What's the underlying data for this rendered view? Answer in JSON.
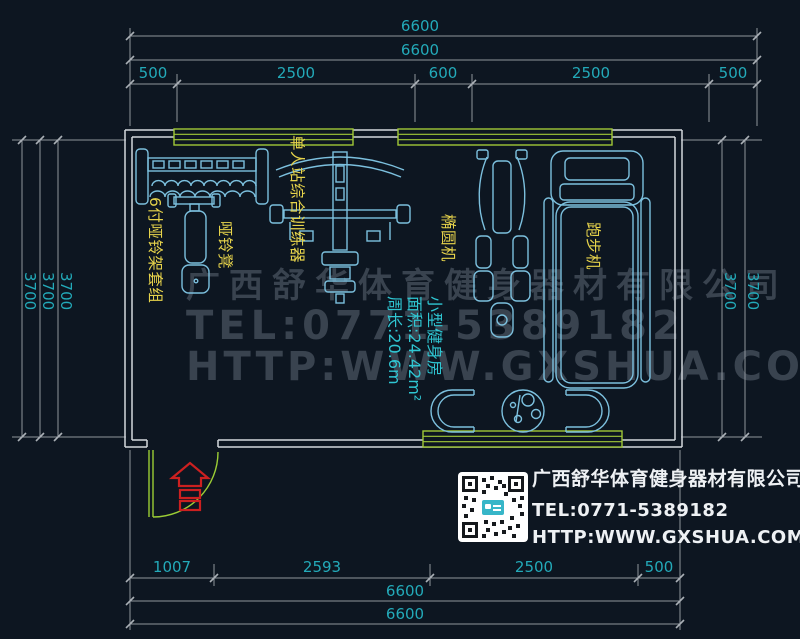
{
  "colors": {
    "background": "#0d1621",
    "dim_line_gray": "#8e959c",
    "dim_text_cyan": "#23aab9",
    "wall_white": "#d3d8dd",
    "window_green": "#a0c838",
    "door_green": "#9bcd35",
    "equipment_cyan": "#7cc0de",
    "label_yellow": "#e6d34b",
    "room_info_cyan": "#2fc6d2",
    "watermark_gray": "#39434f",
    "entrance_red": "#cc2020",
    "company_text_white": "#eef1f4",
    "qr_logo_cyan": "#37b6c8"
  },
  "dimensions": {
    "top": {
      "total_outer": "6600",
      "total_inner": "6600",
      "segments": [
        "500",
        "2500",
        "600",
        "2500",
        "500"
      ]
    },
    "bottom": {
      "segments": [
        "1007",
        "2593",
        "2500",
        "500"
      ],
      "total_inner": "6600",
      "total_outer": "6600"
    },
    "left": [
      "3700",
      "3700",
      "3700"
    ],
    "right": [
      "3700",
      "3700"
    ]
  },
  "equipment_labels": {
    "dumbbell_rack": "6付哑铃架套组",
    "dumbbell_bench": "哑铃凳",
    "single_station_trainer": "单人站综合训练器",
    "elliptical": "椭圆机",
    "treadmill": "跑步机"
  },
  "room_info": {
    "name": "小型健身房",
    "area": "面积:24.42m²",
    "perimeter": "周长:20.6m"
  },
  "watermark": {
    "line1": "广西舒华体育健身器材有限公司",
    "line2": "TEL:0771-5389182",
    "line3": "HTTP:WWW.GXSHUA.COM"
  },
  "company_block": {
    "name": "广西舒华体育健身器材有限公司",
    "tel": "TEL:0771-5389182",
    "url": "HTTP:WWW.GXSHUA.COM"
  }
}
